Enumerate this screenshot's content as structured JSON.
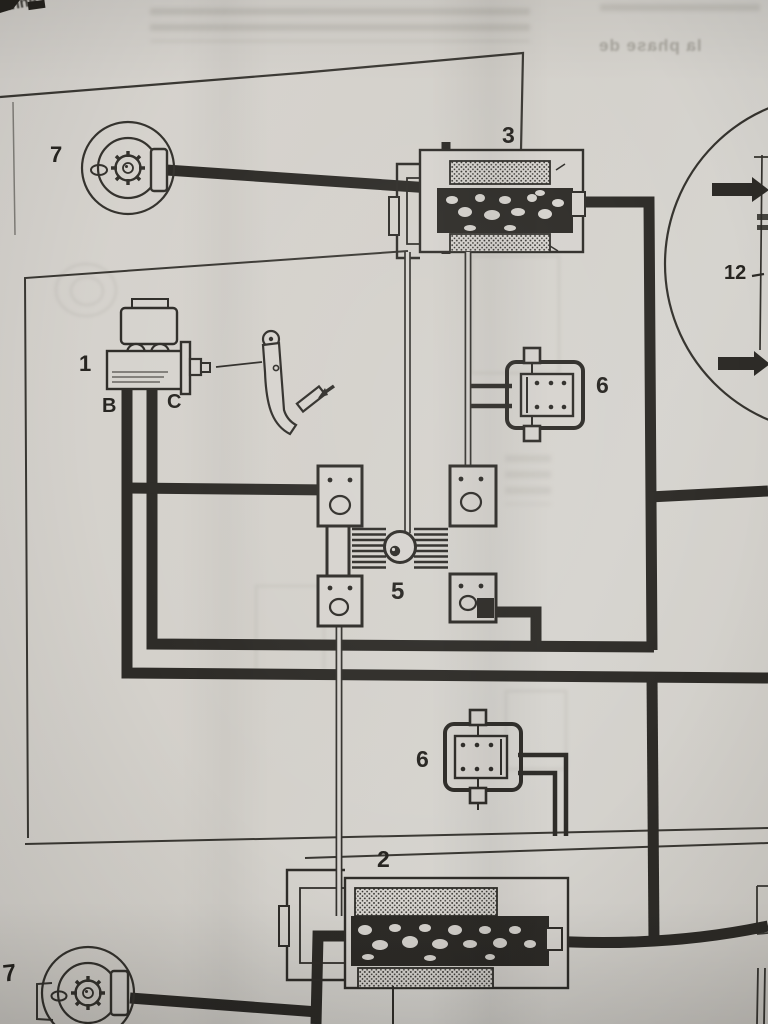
{
  "page": {
    "labels": {
      "wheel_front_top": "7",
      "proportioning_unit_top": "3",
      "master_cylinder": "1",
      "outlet_b": "B",
      "outlet_c": "C",
      "limiter_upper": "6",
      "compensator": "5",
      "servo": "12",
      "limiter_lower": "6",
      "proportioning_unit_bottom": "2",
      "wheel_front_bottom": "7"
    },
    "bleed_through": {
      "corner_fragment": "anne",
      "phrase": "la phase de"
    },
    "colors": {
      "paper": "#d3d0ca",
      "ink": "#2d2b27"
    }
  }
}
